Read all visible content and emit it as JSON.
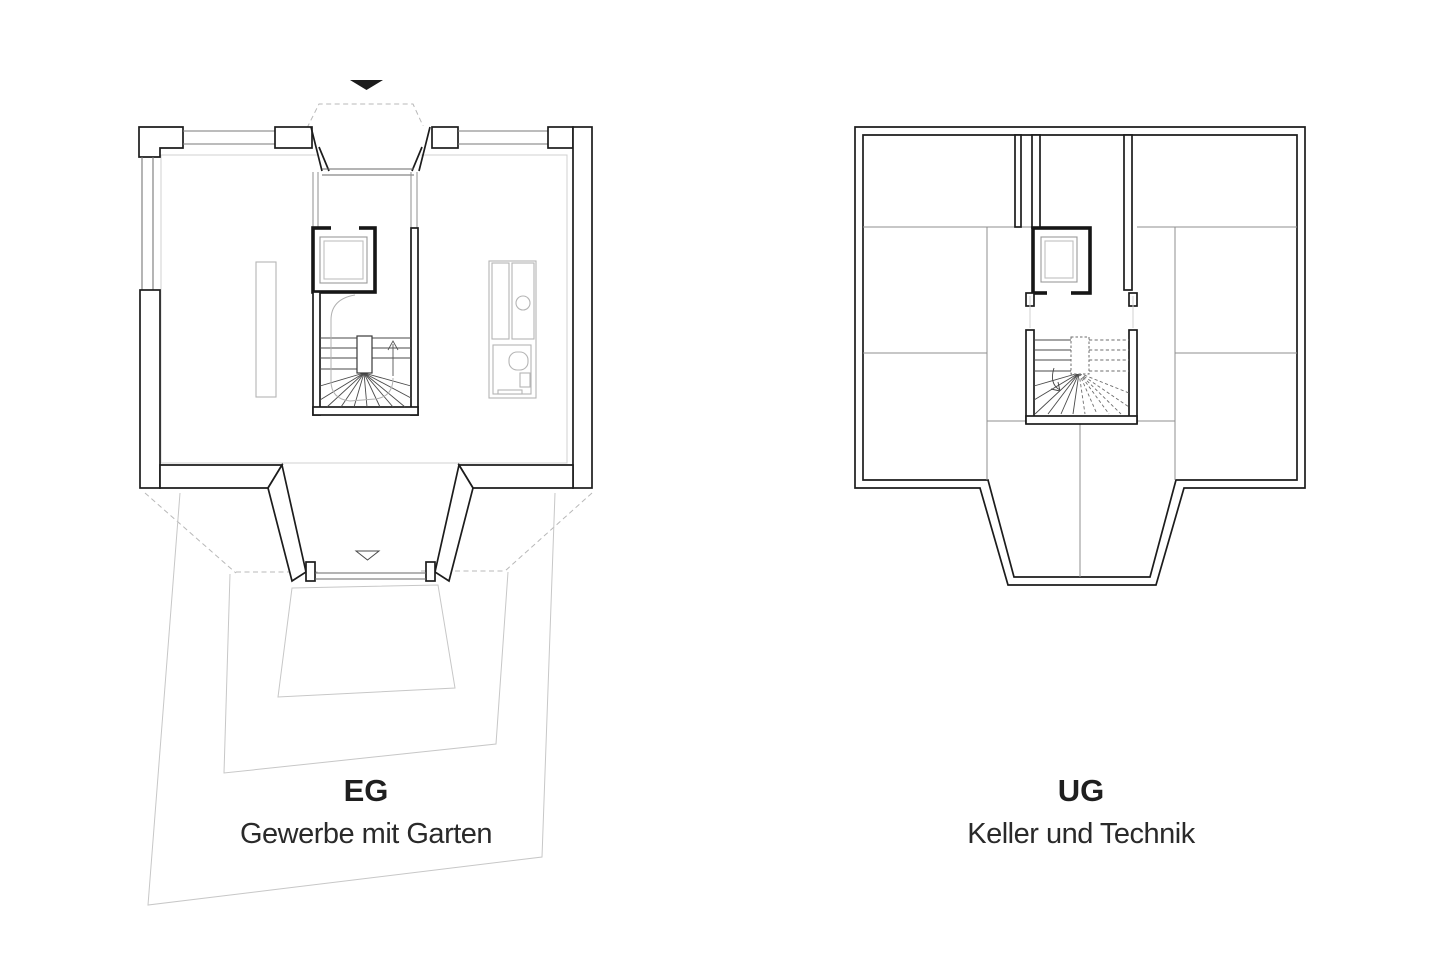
{
  "sheet": {
    "description": "Architectural drawing sheet with two floor plans side by side",
    "background": "#ffffff"
  },
  "colors": {
    "wall": "#1c1c1c",
    "partition": "#8f8f8f",
    "fixture": "#b5b5b5",
    "garden": "#c7c7c7",
    "projection_dash": "#b8b8b8",
    "tread": "#4a4a4a",
    "text": "#1f1f1f"
  },
  "plans": [
    {
      "id": "eg",
      "title": "EG",
      "subtitle": "Gewerbe mit Garten",
      "features": [
        "entrance-direction-arrow",
        "dashed-canopy-projection",
        "recessed-entrance",
        "shop-windows",
        "elevator-with-car",
        "winder-stair-up-arrow",
        "counter-furniture",
        "kitchenette-with-sink",
        "wc-with-toilet",
        "recessed-garden-exit",
        "terraced-garden-outlines",
        "dashed-upper-floor-projection"
      ]
    },
    {
      "id": "ug",
      "title": "UG",
      "subtitle": "Keller und Technik",
      "features": [
        "cellar-rooms",
        "central-corridor",
        "technik-room",
        "duct-shaft",
        "elevator-with-car",
        "winder-stair-down-arrow",
        "dashed-treads-above"
      ]
    }
  ],
  "icons": [
    {
      "name": "north-entry-arrow",
      "glyph": "filled triangle pointing down"
    },
    {
      "name": "garden-exit-marker",
      "glyph": "open triangle pointing down"
    },
    {
      "name": "stair-up-arrow",
      "glyph": "straight arrow pointing up"
    },
    {
      "name": "stair-down-arrow",
      "glyph": "curved arrow pointing down"
    }
  ]
}
